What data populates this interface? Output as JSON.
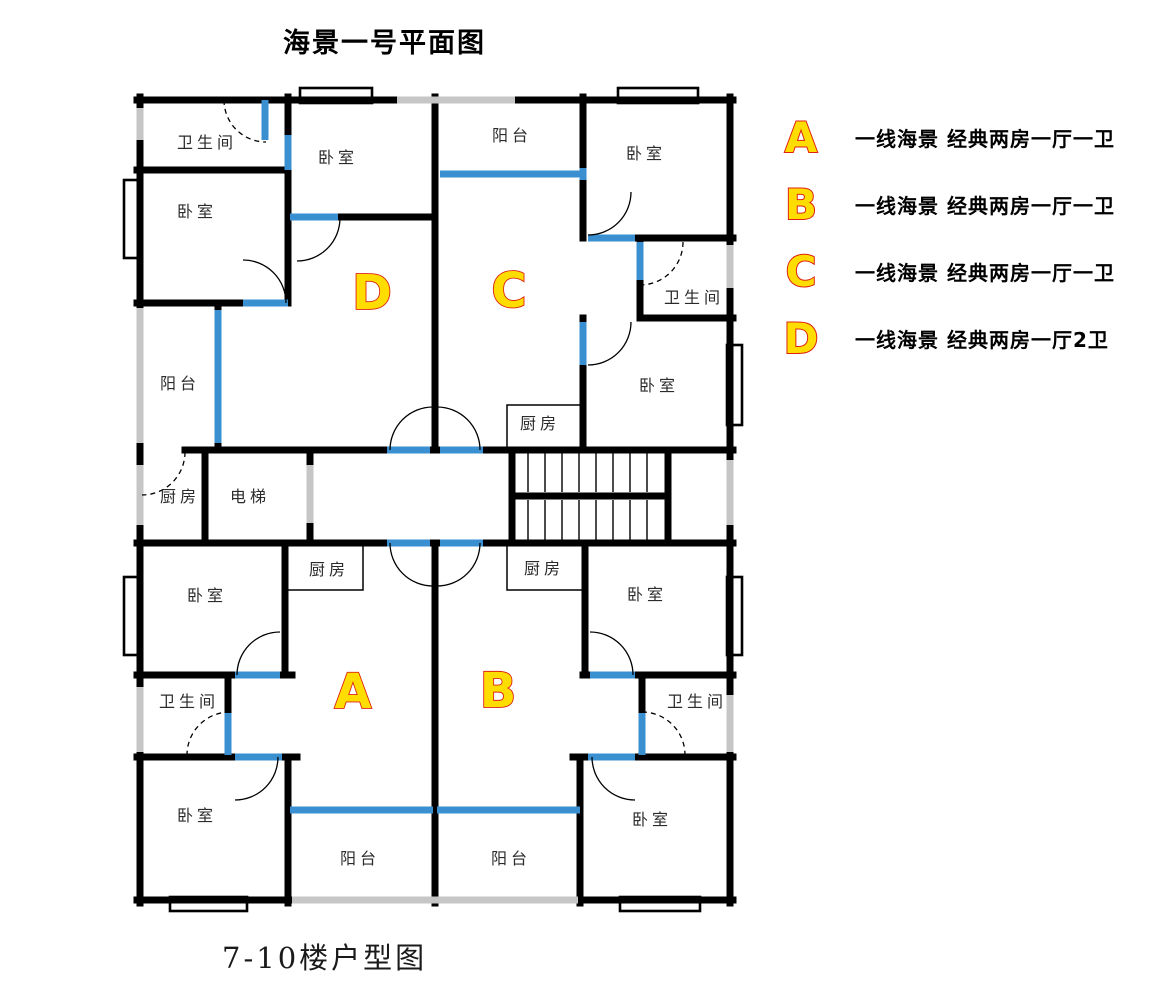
{
  "title": "海景一号平面图",
  "footer": "7-10楼户型图",
  "legend": {
    "items": [
      {
        "letter": "A",
        "desc": "一线海景 经典两房一厅一卫"
      },
      {
        "letter": "B",
        "desc": "一线海景 经典两房一厅一卫"
      },
      {
        "letter": "C",
        "desc": "一线海景 经典两房一厅一卫"
      },
      {
        "letter": "D",
        "desc": "一线海景 经典两房一厅2卫"
      }
    ]
  },
  "plan": {
    "units": [
      {
        "letter": "A"
      },
      {
        "letter": "B"
      },
      {
        "letter": "C"
      },
      {
        "letter": "D"
      }
    ],
    "rooms": [
      {
        "name": "d-bathroom",
        "label": "卫生间"
      },
      {
        "name": "d-bedroom-1",
        "label": "卧室"
      },
      {
        "name": "d-bedroom-2",
        "label": "卧室"
      },
      {
        "name": "c-balcony",
        "label": "阳台"
      },
      {
        "name": "c-bedroom-1",
        "label": "卧室"
      },
      {
        "name": "c-bathroom",
        "label": "卫生间"
      },
      {
        "name": "c-bedroom-2",
        "label": "卧室"
      },
      {
        "name": "d-balcony",
        "label": "阳台"
      },
      {
        "name": "c-kitchen",
        "label": "厨房"
      },
      {
        "name": "d-kitchen",
        "label": "厨房"
      },
      {
        "name": "elevator",
        "label": "电梯"
      },
      {
        "name": "a-kitchen",
        "label": "厨房"
      },
      {
        "name": "b-kitchen",
        "label": "厨房"
      },
      {
        "name": "a-bedroom-1",
        "label": "卧室"
      },
      {
        "name": "b-bedroom-1",
        "label": "卧室"
      },
      {
        "name": "a-bathroom",
        "label": "卫生间"
      },
      {
        "name": "b-bathroom",
        "label": "卫生间"
      },
      {
        "name": "a-bedroom-2",
        "label": "卧室"
      },
      {
        "name": "b-bedroom-2",
        "label": "卧室"
      },
      {
        "name": "a-balcony",
        "label": "阳台"
      },
      {
        "name": "b-balcony",
        "label": "阳台"
      }
    ]
  },
  "colors": {
    "wall": "#000000",
    "window_blue": "#3a8fd0",
    "railing_gray": "#c6c6c6",
    "unit_letter_fill": "#ffdd00",
    "unit_letter_stroke": "#dd2211"
  }
}
